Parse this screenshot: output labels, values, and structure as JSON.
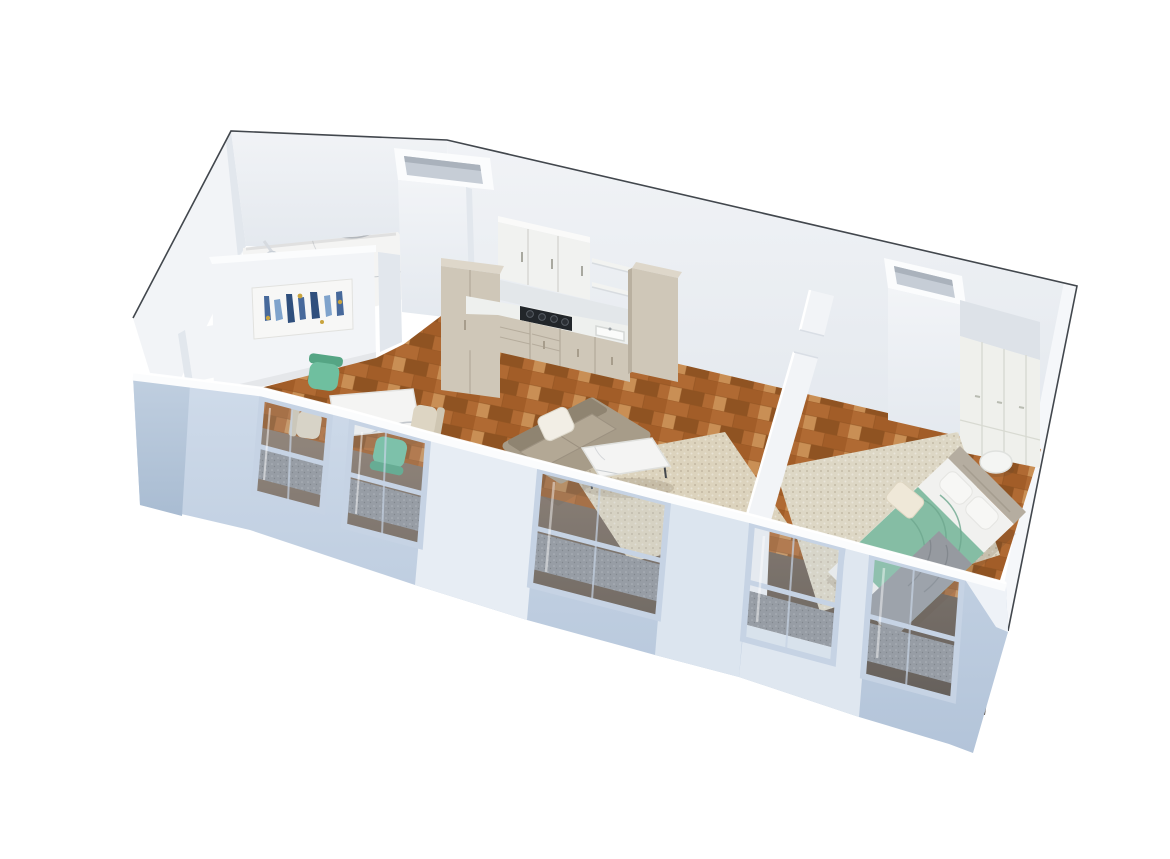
{
  "image": {
    "type": "3d-floor-plan-render",
    "style": "isometric cutaway dollhouse view of a one-bedroom apartment",
    "background_color": "#ffffff"
  },
  "palette": {
    "wall_white": "#f2f4f7",
    "wall_shade": "#e2e7ed",
    "wall_top": "#fbfcfd",
    "exterior_blue": "#c4d1e2",
    "exterior_blue_dark": "#aabdd3",
    "pier_light": "#e7edf4",
    "window_frame": "#c6d3e4",
    "radiator": "#8f9399",
    "wood": "#b06a33",
    "wood_dark": "#8f5322",
    "wood_light": "#c98f55",
    "wood_mid": "#a25d28",
    "marble": "#f4f4f3",
    "marble_vein": "#b7bcc2",
    "cabinet": "#cfc7b8",
    "cabinet_dark": "#b9b0a0",
    "cabinet_top": "#ded7ca",
    "counter": "#eef0ee",
    "cooktop": "#22262a",
    "upper_cab": "#f1f2f0",
    "shelf": "#f2f3f1",
    "sofa": "#a79c89",
    "sofa_dark": "#8f8471",
    "pillow": "#f2eee5",
    "rug_living": "#dcd3bd",
    "rug_bedroom": "#ddd7c5",
    "chair_teal": "#6fbf9f",
    "chair_teal_dark": "#55a584",
    "chair_cream": "#ddd5c3",
    "bed_linen": "#f1f1ef",
    "blanket_teal": "#85bda4",
    "blanket_teal_dark": "#6ea88e",
    "blanket_gray": "#969aa0",
    "headboard": "#b5ada0",
    "wardrobe": "#eff0ec",
    "wardrobe_line": "#d8dad2",
    "soffit": "#dde2e8",
    "art_blue": "#47699b",
    "art_blue_dark": "#2f4f7d",
    "art_blue_light": "#7fa3cc",
    "art_gold": "#c9a43e",
    "outline": "#42474d"
  },
  "rooms": [
    {
      "id": "bathroom",
      "label": "Bathroom",
      "features": [
        "white marble floor with gray veining",
        "rain shower head",
        "white partition walls",
        "service shaft with open top"
      ]
    },
    {
      "id": "kitchen",
      "label": "Kitchen",
      "features": [
        "white shaker upper cabinets",
        "two open shelves",
        "black gas cooktop",
        "white countertop with undermount sink",
        "beige base cabinets with drawers",
        "two tall beige cabinet columns"
      ]
    },
    {
      "id": "living-dining",
      "label": "Living / Dining room",
      "features": [
        "oak parquet floor",
        "abstract wall art in blue and gold",
        "marble-top dining table",
        "two teal chairs",
        "two cream chairs",
        "taupe two-seat sofa with white pillow",
        "marble coffee table with thin legs",
        "woven beige area rug"
      ]
    },
    {
      "id": "bedroom",
      "label": "Bedroom",
      "features": [
        "double bed with white linen",
        "sage green throw blanket",
        "gray folded blanket",
        "two white pillows and one cream pillow",
        "taupe upholstered headboard",
        "round white side table",
        "full-height white wardrobe",
        "gray soffit",
        "service shaft column",
        "cream textured rug"
      ]
    }
  ],
  "exterior": {
    "windows_count": 5,
    "window_style": "tall frames with center rail seen from above",
    "radiators_under_windows": 5,
    "front_wall_color_note": "cool blue-gray cut walls with bright white tops",
    "unit_outline_note": "thin dark contour traced around the top and right edges of the unit"
  }
}
